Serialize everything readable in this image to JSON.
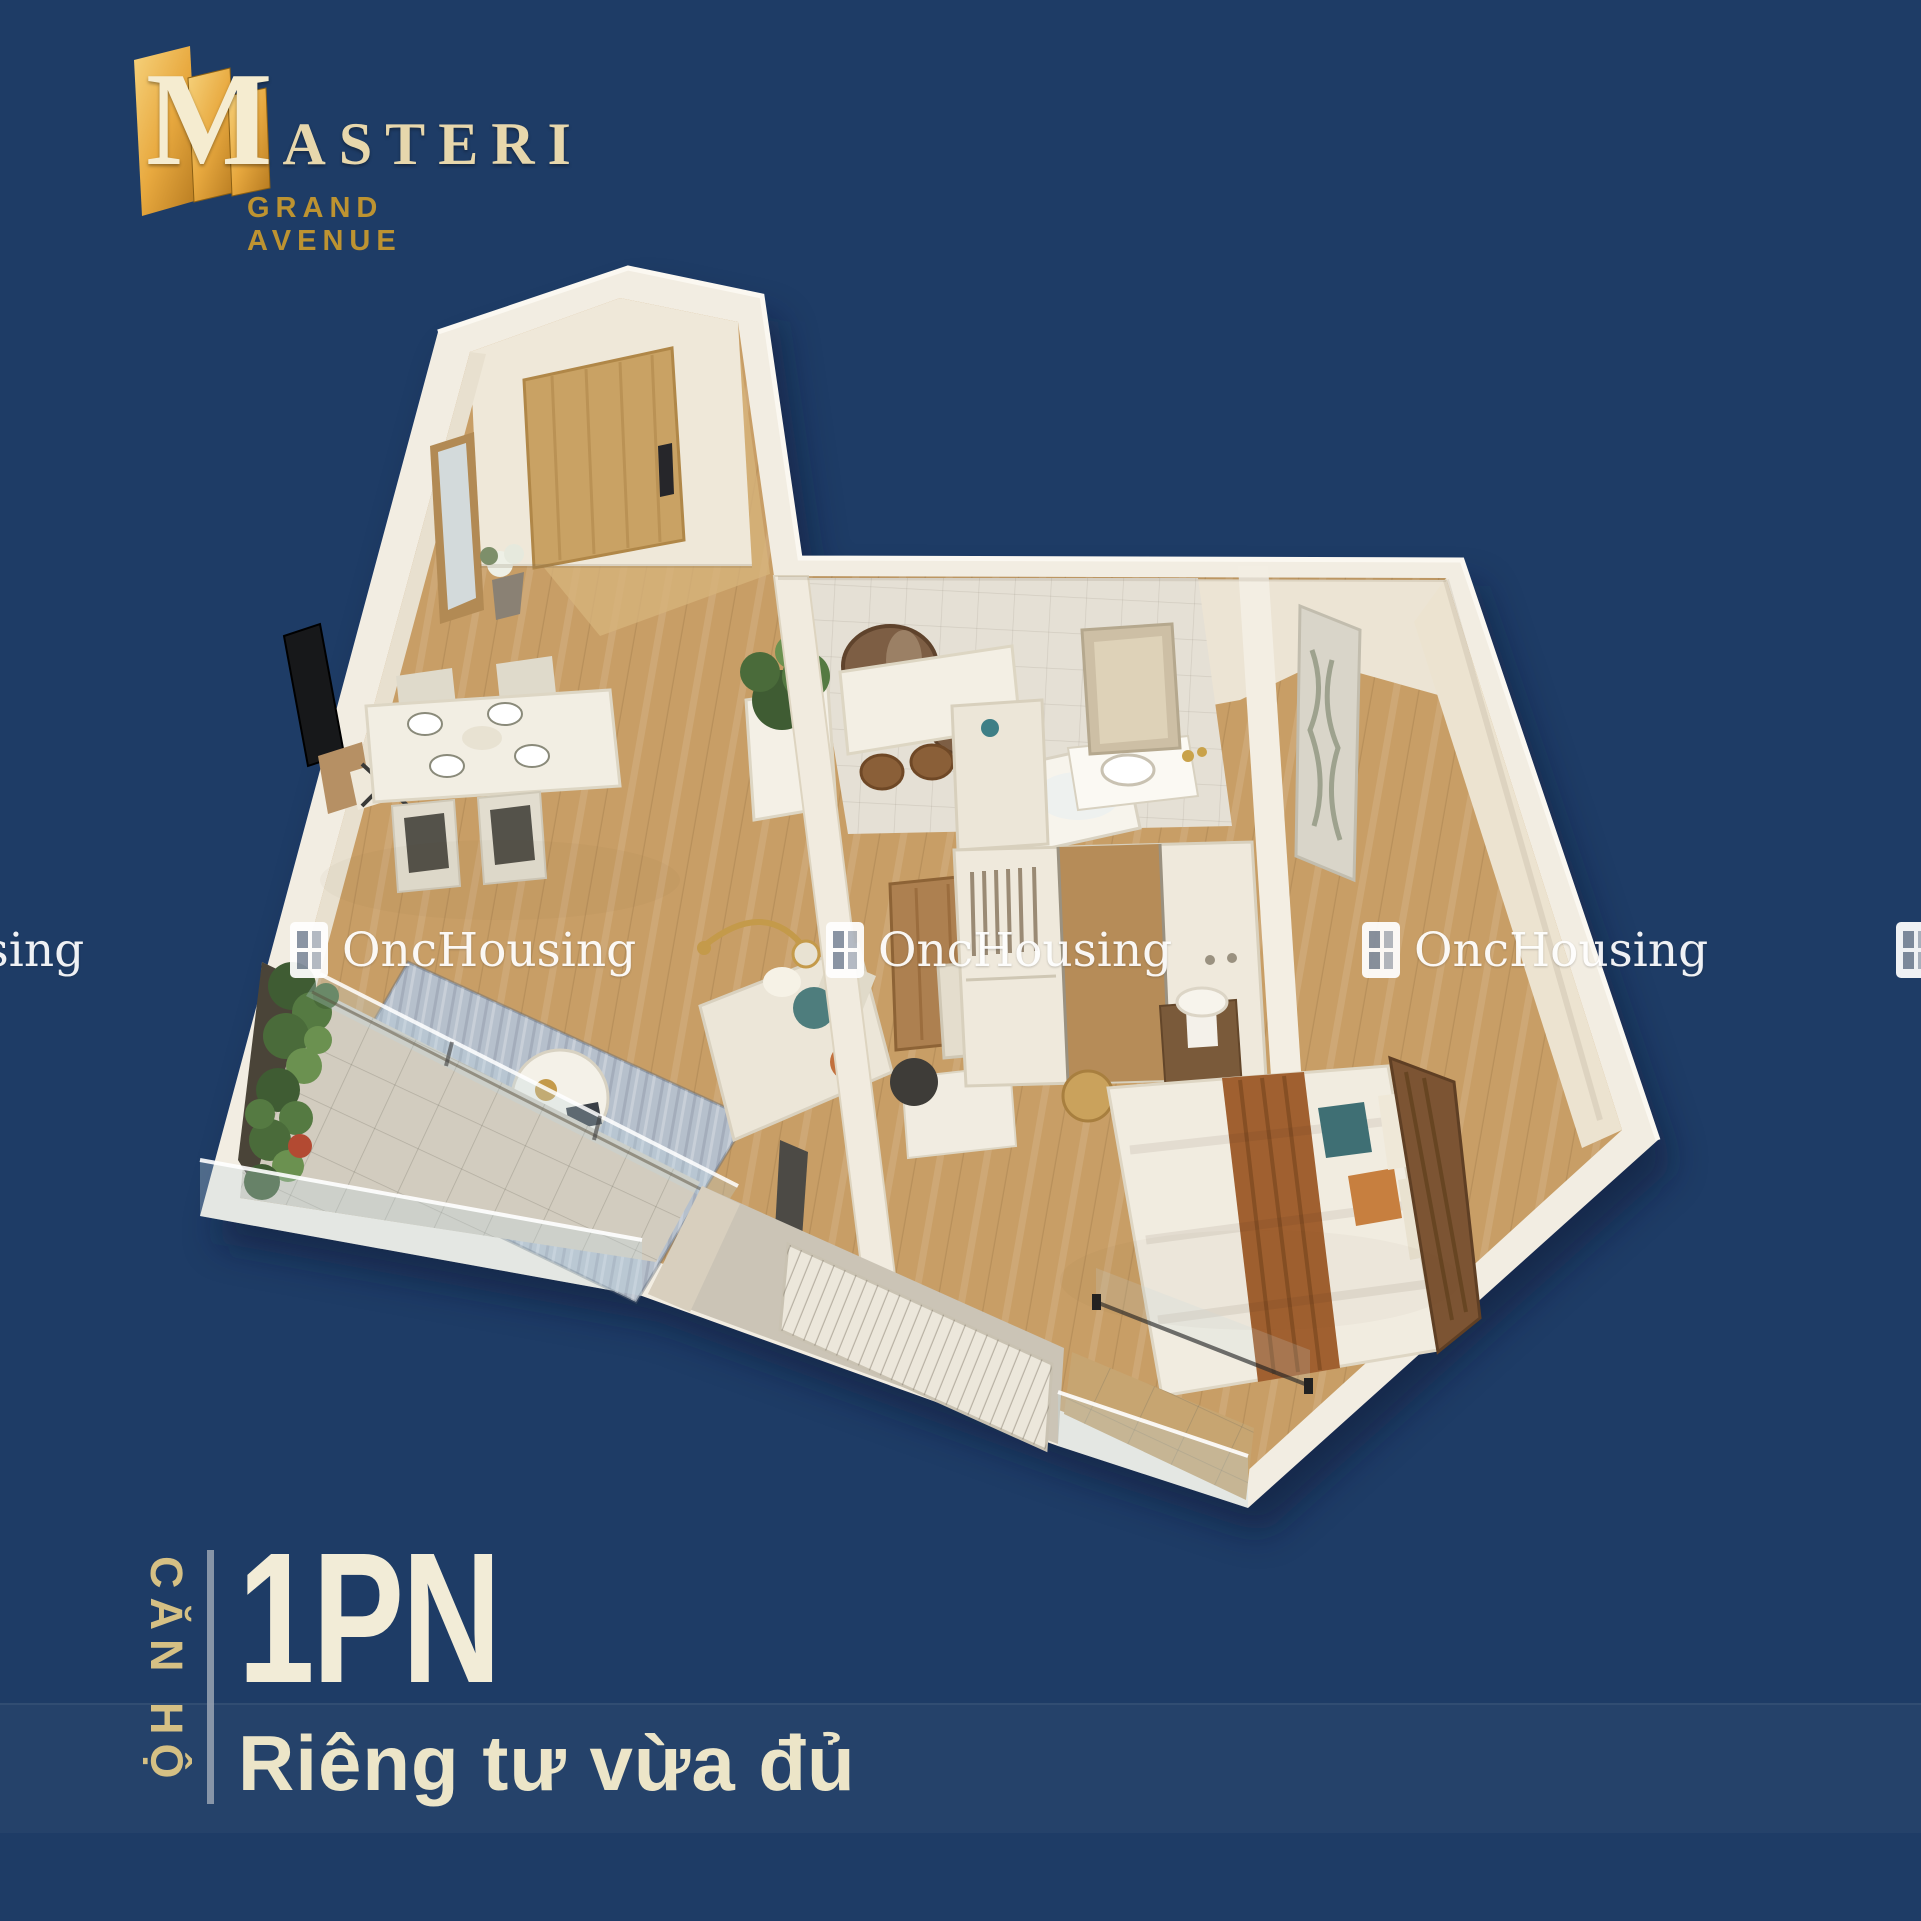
{
  "brand": {
    "initial": "M",
    "rest": "ASTERI",
    "tagline": "GRAND AVENUE",
    "mark_icon": "gold-building-mark-icon",
    "colors": {
      "gold_light": "#f6d27c",
      "gold": "#d99b31",
      "gold_dark": "#a86f1f",
      "lettering": "#ecdcb0",
      "tagline": "#bd9331"
    }
  },
  "watermark": {
    "text": "OncHousing",
    "icon": "window-grid-icon",
    "color": "#ffffff"
  },
  "caption": {
    "label_vertical": "CĂN HỘ",
    "headline": "1PN",
    "subtitle": "Riêng tư vừa đủ",
    "label_color": "#d5c084",
    "headline_color": "#f2ecd7",
    "divider_color": "#99a3b3"
  },
  "background": {
    "color": "#1e3c66",
    "band_color": "rgba(255,255,255,0.03)"
  },
  "floor_plan": {
    "type": "3d-apartment-cutaway-render",
    "rooms": [
      "entry-hall",
      "living-dining",
      "foyer-console",
      "bathroom",
      "wardrobe-corridor",
      "bedroom",
      "main-balcony",
      "ac-ledge",
      "bedroom-balcony"
    ],
    "palette": {
      "walls": "#f2ede2",
      "wood_floor": "#c89e66",
      "balcony_tile": "#d2ccbf",
      "rug": "#b6c0cc",
      "bed_runner": "#a06030",
      "plants": "#4f7140",
      "accent_teal": "#3f6f74",
      "accent_orange": "#c77f3f"
    }
  }
}
